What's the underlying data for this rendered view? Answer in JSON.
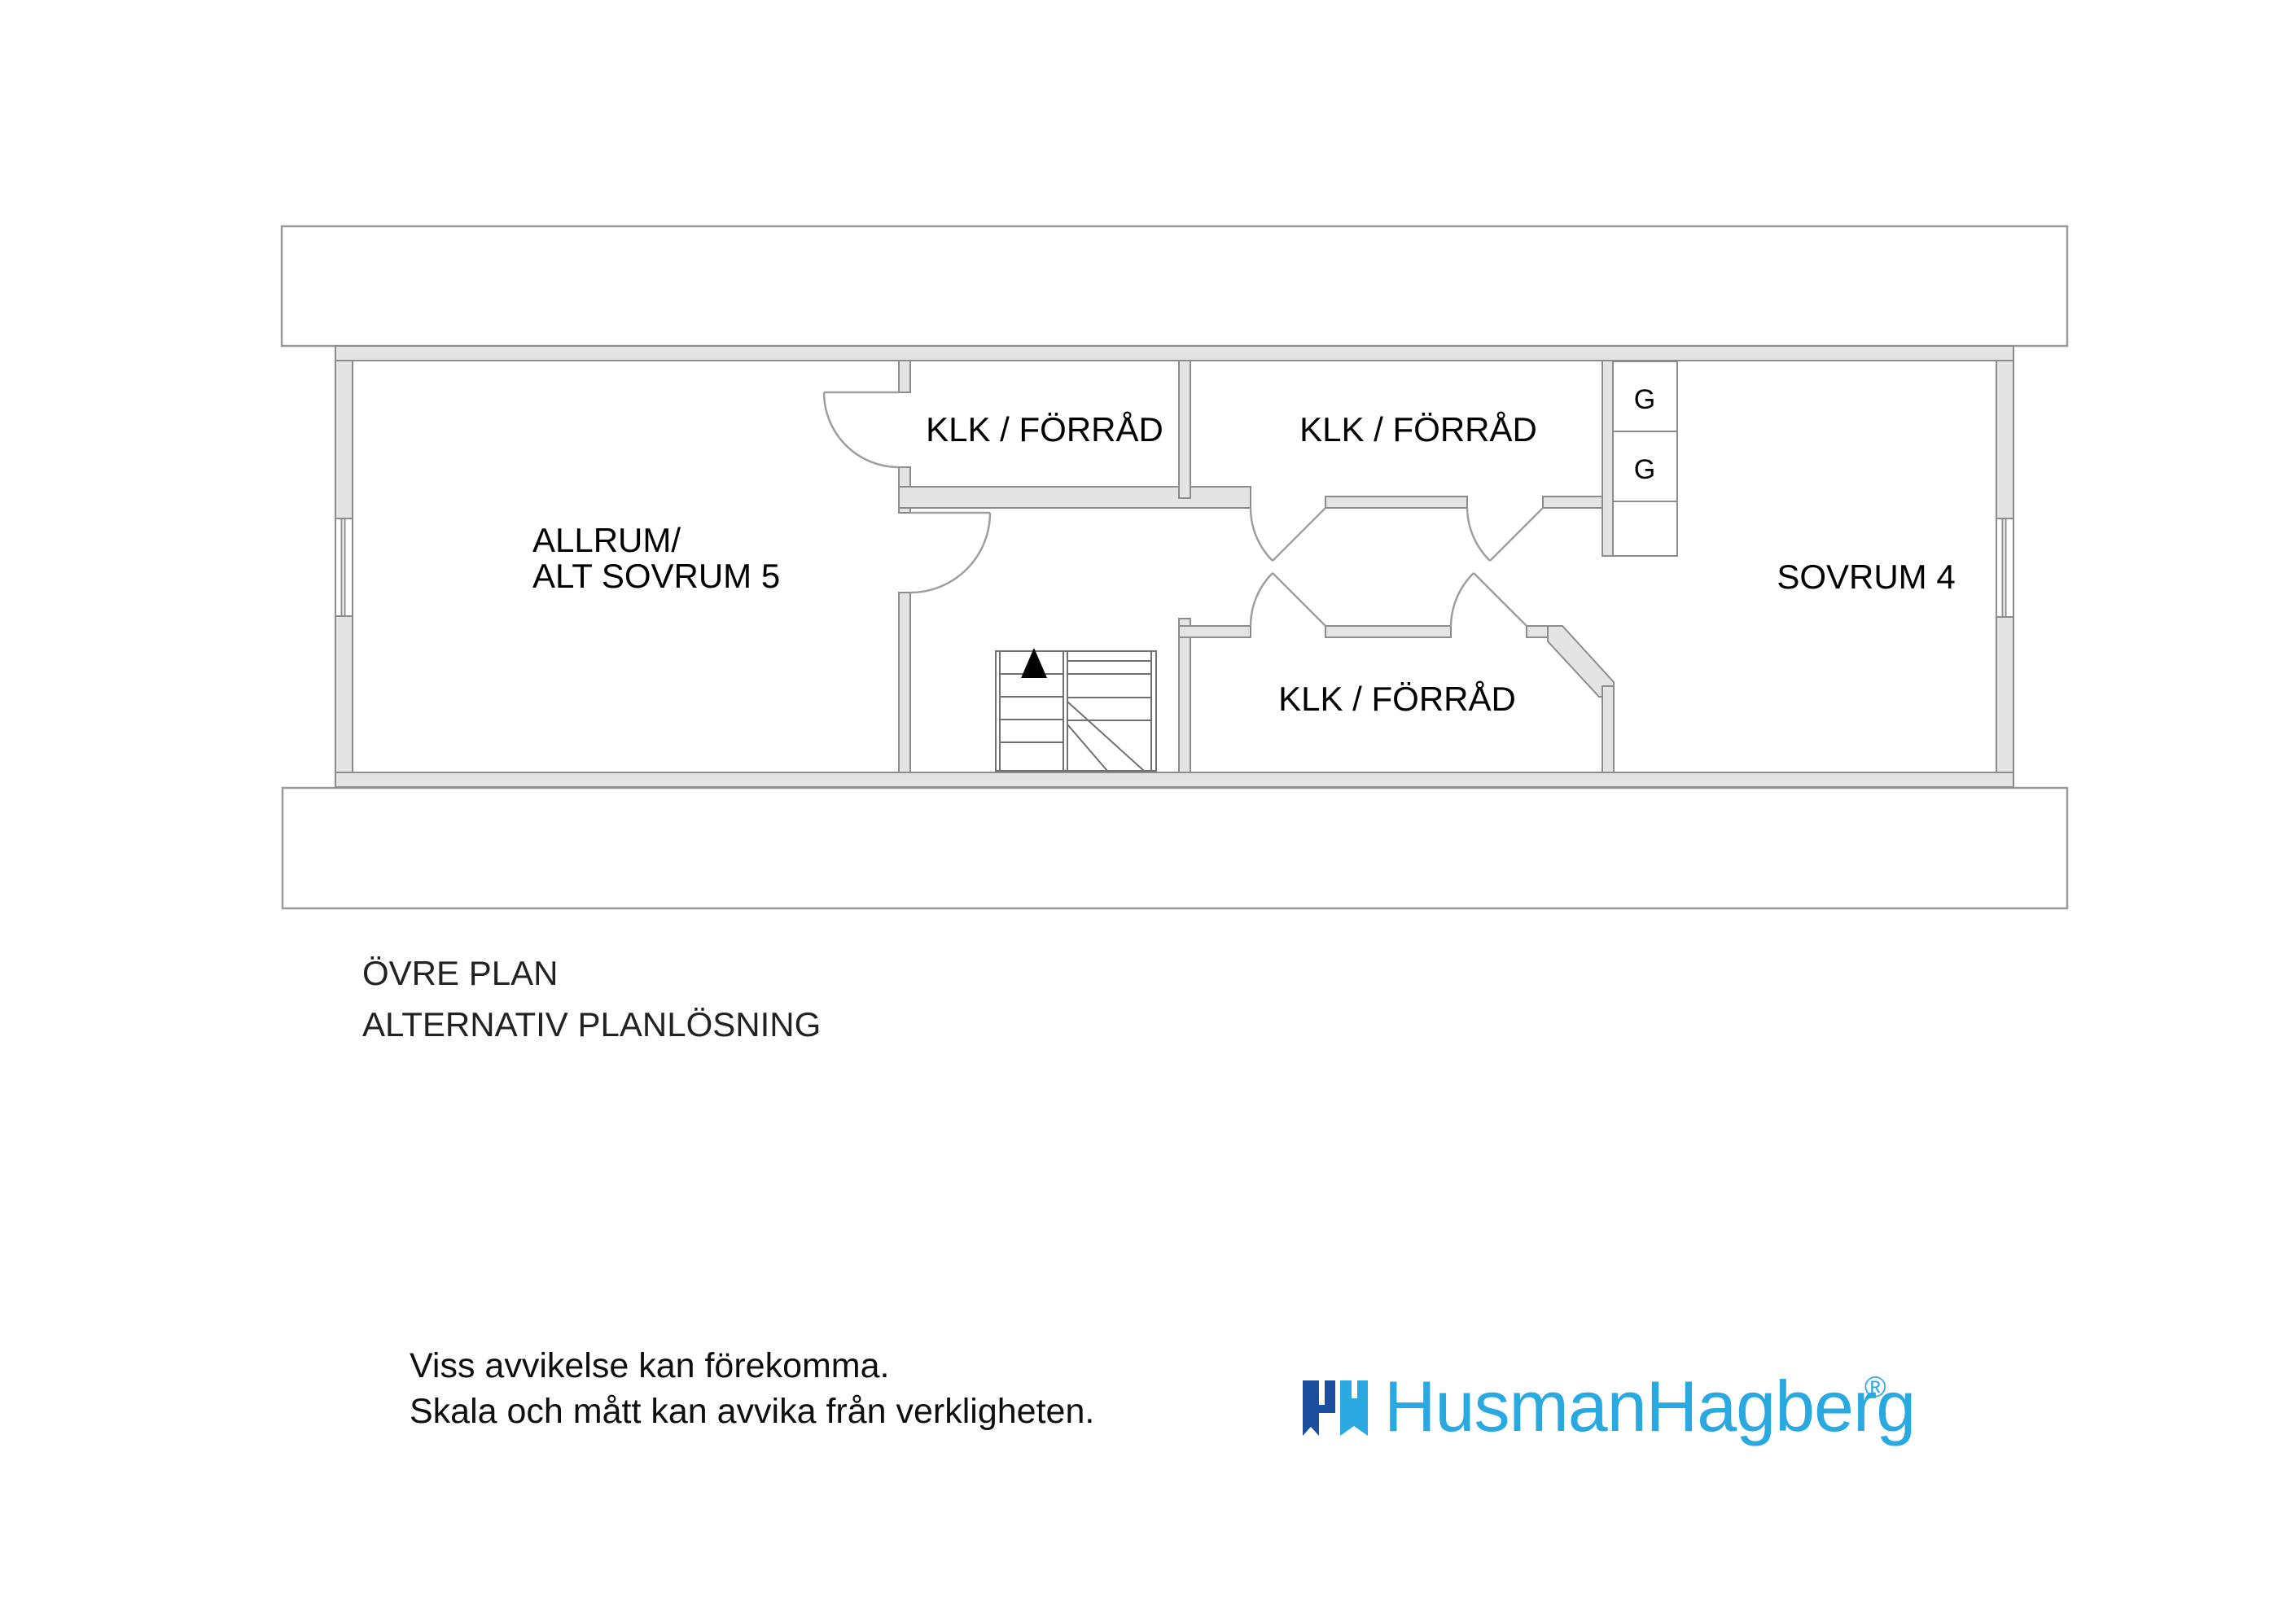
{
  "colors": {
    "page_bg": "#ffffff",
    "wall_fill": "#e4e4e4",
    "wall_stroke": "#8c8c8c",
    "band_stroke": "#9a9a9a",
    "door_stroke": "#9f9f9f",
    "stair_stroke": "#707070",
    "text_color": "#000000",
    "logo_light_blue": "#29a9e0",
    "logo_dark_blue": "#1b4f9e"
  },
  "floorplan": {
    "rooms": [
      {
        "id": "allrum",
        "label_line1": "ALLRUM/",
        "label_line2": "ALT SOVRUM 5"
      },
      {
        "id": "klk-forrad-top-left",
        "label": "KLK / FÖRRÅD"
      },
      {
        "id": "klk-forrad-top-right",
        "label": "KLK / FÖRRÅD"
      },
      {
        "id": "klk-forrad-bottom",
        "label": "KLK / FÖRRÅD"
      },
      {
        "id": "sovrum-4",
        "label": "SOVRUM 4"
      }
    ],
    "wardrobes": [
      {
        "label": "G"
      },
      {
        "label": "G"
      }
    ]
  },
  "captions": {
    "floor_name": "ÖVRE PLAN",
    "layout_variant": "ALTERNATIV PLANLÖSNING"
  },
  "disclaimer": {
    "line1": "Viss avvikelse kan förekomma.",
    "line2": "Skala och mått kan avvika från verkligheten."
  },
  "logo": {
    "name": "HusmanHagberg",
    "registered_symbol": "®"
  }
}
